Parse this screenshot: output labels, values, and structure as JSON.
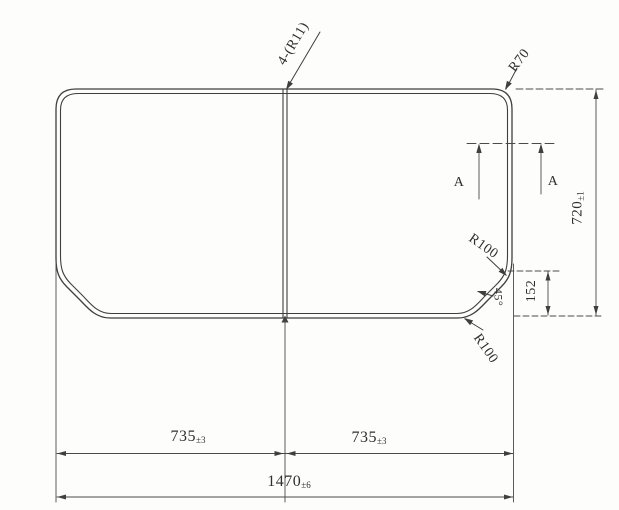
{
  "drawing": {
    "type": "technical-drawing",
    "subject": "two-piece-panel-plan-view",
    "colors": {
      "line": "#3f3f3f",
      "dim_line": "#4a4a4a",
      "background": "#fdfdfb",
      "text": "#2f2f2f"
    },
    "labels": {
      "corner_note": "4-(R11)",
      "top_right_radius": "R70",
      "section_left": "A",
      "section_right": "A",
      "height": {
        "value": "720",
        "tol": "±1"
      },
      "chamfer_height": "152",
      "chamfer_radius_upper": "R100",
      "chamfer_angle": "45°",
      "chamfer_radius_lower": "R100",
      "width_left": {
        "value": "735",
        "tol": "±3"
      },
      "width_right": {
        "value": "735",
        "tol": "±3"
      },
      "width_total": {
        "value": "1470",
        "tol": "±6"
      }
    }
  }
}
